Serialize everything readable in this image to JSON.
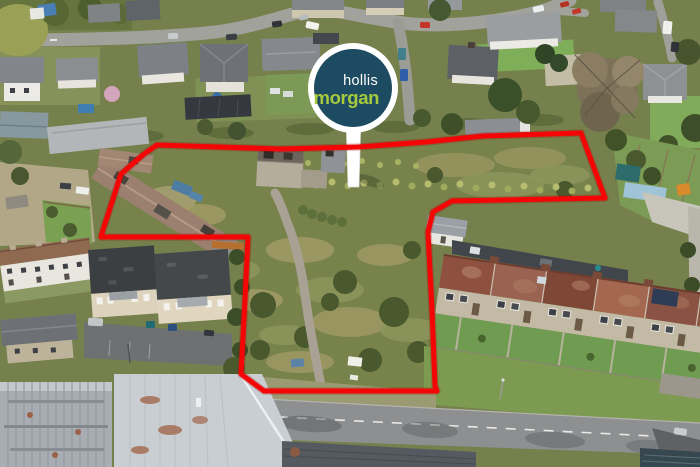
{
  "photo": {
    "type": "aerial-drone-photograph",
    "description": "Overhead drone view of a village development site of scrubland and derelict stone barns, outlined in red, between housing estates, terraced houses and a main road"
  },
  "sign": {
    "line1": "hollis",
    "line2": "morgan",
    "disc_color": "#1d4b61",
    "line1_color": "#ffffff",
    "line2_color": "#a6c93e",
    "board_color": "#ffffff"
  },
  "boundary": {
    "color": "#f40606",
    "glow_color": "#9e0a04",
    "stroke_width": 5,
    "points": "157,145 280,149 358,147 426,142 483,136 581,133 605,198 452,201 433,212 428,232 432,310 435,386 437,391 350,391 264,391 241,374 245,300 248,237 101,237 103,230 121,174 144,154 157,145"
  }
}
